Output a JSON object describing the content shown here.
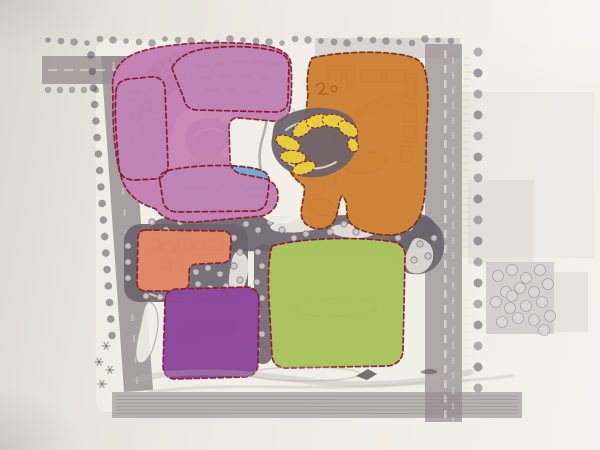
{
  "photo": {
    "subject": "master-plan-site-diagram",
    "media": "printed plan photograph with marker-highlighted zones"
  },
  "colors": {
    "paper": "#e8e5de",
    "planPaper": "#f1eee7",
    "road": "#958c90",
    "canopy": "#6b636b",
    "tree": "#575058",
    "dotFill": "#cfc8cb",
    "dotRim": "#7b737b",
    "pink": "#c583b4",
    "blue": "#6aa5c8",
    "fan": "#8c4b96",
    "fanStripe": "#4f2363",
    "orange": "#d08438",
    "orangeDeep": "#8a4a1d",
    "salmon": "#e08a66",
    "purple": "#8e4a9c",
    "purplePill": "#7a3a8a",
    "green": "#abc45f",
    "yellow": "#ecd23a",
    "border": "#8b1d32",
    "borderWarm": "#7e2a12",
    "penGreen": "#7f9340",
    "scribBlue": "#2e648e",
    "scribRed": "#8a301c",
    "plazaGrey": "#8a8287",
    "plazaGreyLight": "#b9b2b6"
  },
  "zones": [
    {
      "id": "pink-cluster",
      "color_key": "pink",
      "outline": "dashed"
    },
    {
      "id": "blue-block-north",
      "color_key": "blue",
      "outline": "dashed"
    },
    {
      "id": "blue-block-west",
      "color_key": "blue",
      "outline": "dashed"
    },
    {
      "id": "blue-block-south",
      "color_key": "blue",
      "outline": "dashed"
    },
    {
      "id": "fan-building",
      "color_key": "fan",
      "outline": "none"
    },
    {
      "id": "orange-district",
      "color_key": "orange",
      "outline": "dashed"
    },
    {
      "id": "yellow-pavilions",
      "color_key": "yellow",
      "outline": "dashed"
    },
    {
      "id": "salmon-block",
      "color_key": "salmon",
      "outline": "dashed"
    },
    {
      "id": "purple-block",
      "color_key": "purple",
      "outline": "dashed"
    },
    {
      "id": "green-field",
      "color_key": "green",
      "outline": "dashed"
    }
  ]
}
